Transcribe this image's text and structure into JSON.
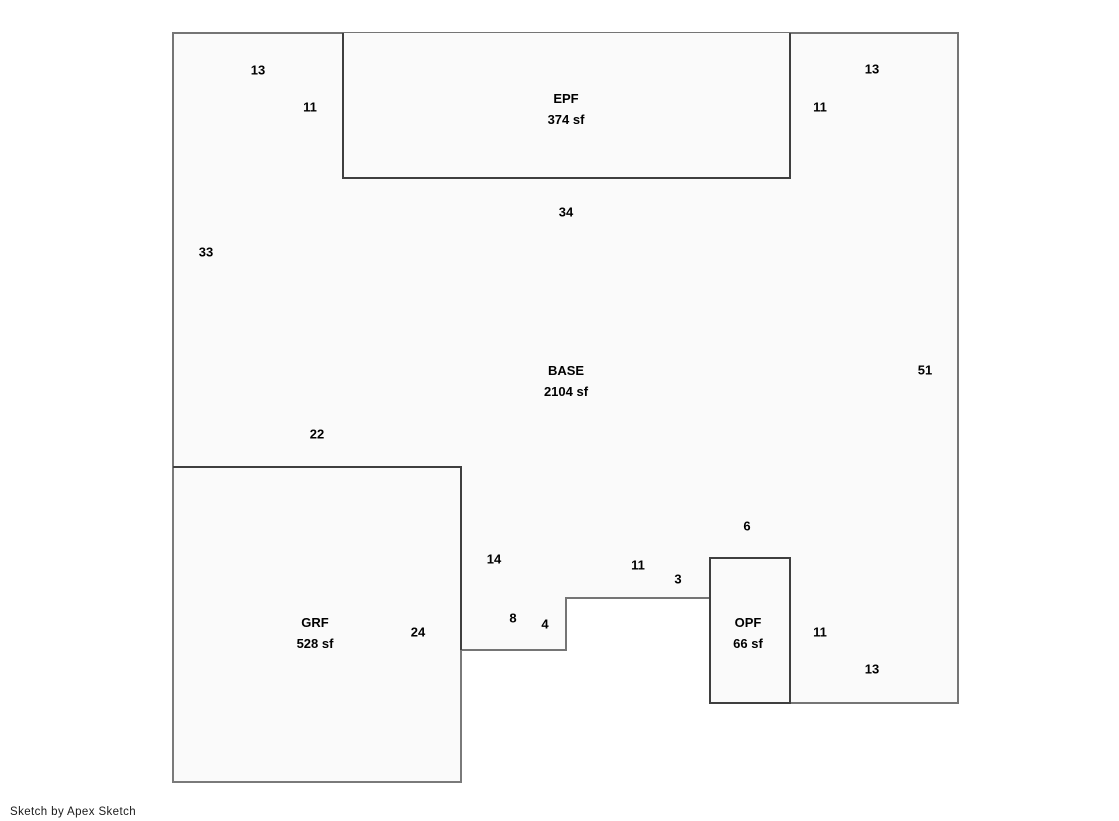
{
  "footer": {
    "credit": "Sketch by Apex Sketch"
  },
  "colors": {
    "background": "#ffffff",
    "shape_fill": "#fafafa",
    "outline_stroke": "#757575",
    "subarea_stroke": "#3f3f3f",
    "label_text": "#000000"
  },
  "areas": {
    "epf": {
      "name": "EPF",
      "size": "374 sf"
    },
    "base": {
      "name": "BASE",
      "size": "2104 sf"
    },
    "grf": {
      "name": "GRF",
      "size": "528 sf"
    },
    "opf": {
      "name": "OPF",
      "size": "66 sf"
    }
  },
  "dims": {
    "top_left_width": "13",
    "epf_left_height": "11",
    "top_right_width": "13",
    "epf_right_height": "11",
    "epf_bottom_width": "34",
    "left_side_height": "33",
    "right_side_height": "51",
    "grf_top_width": "22",
    "grf_right_upper_height": "14",
    "opf_top_width": "6",
    "mid_step_width": "11",
    "opf_left_upper_height": "3",
    "left_step_width": "8",
    "left_step_height": "4",
    "grf_right_height": "24",
    "opf_right_height": "11",
    "bottom_right_width": "13"
  }
}
